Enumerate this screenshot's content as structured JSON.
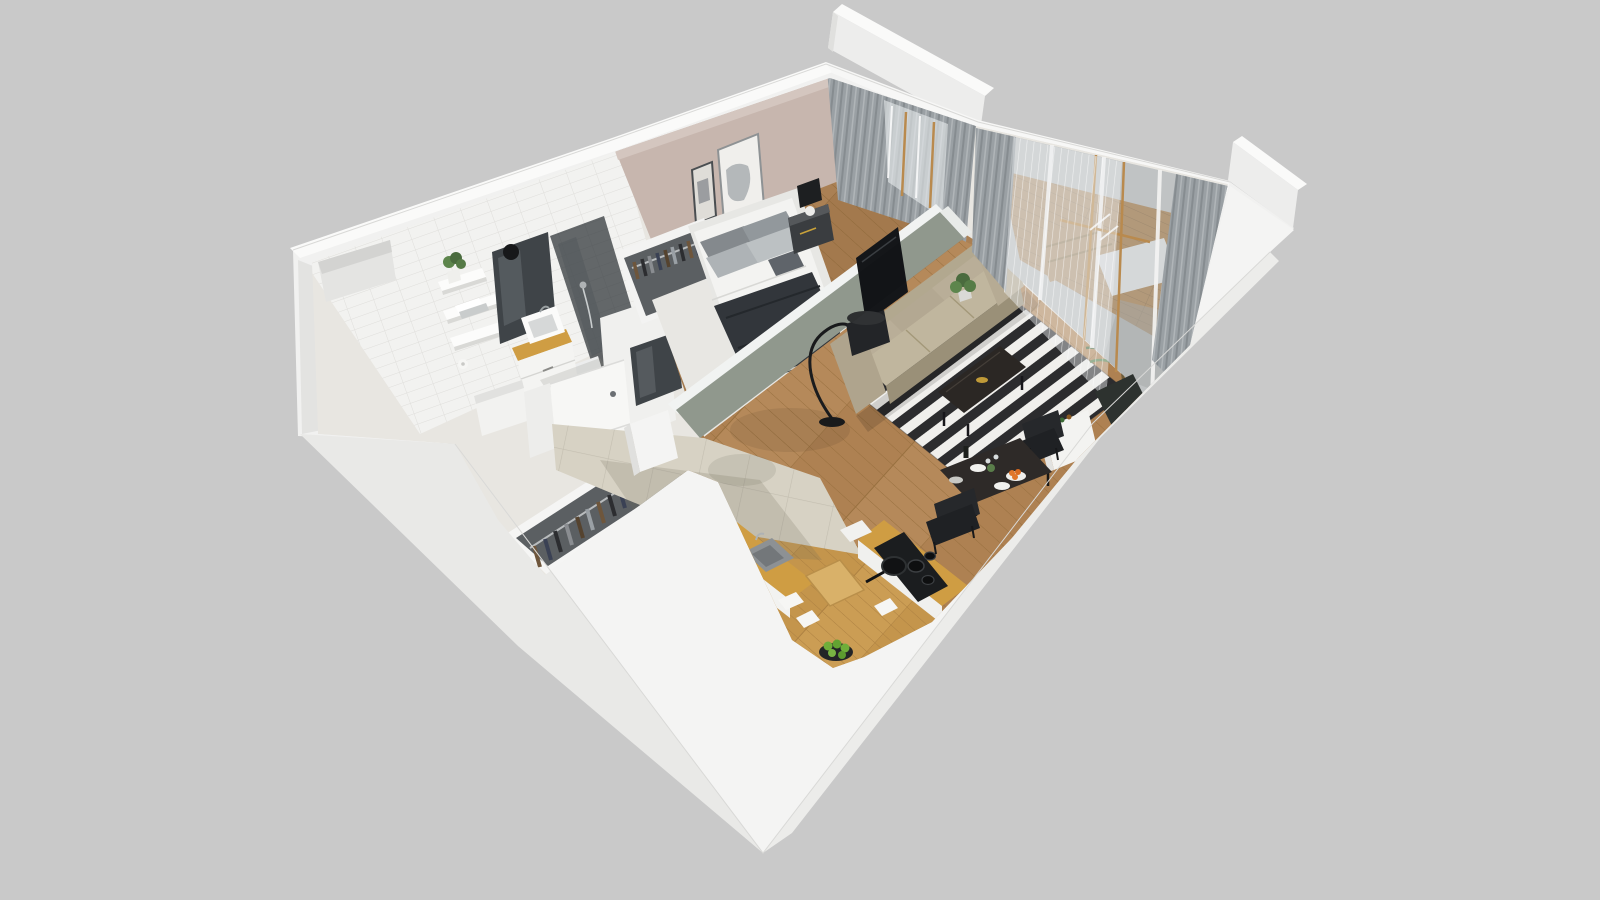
{
  "scene": {
    "type": "3d-floor-plan-render",
    "view": "isometric-cutaway-apartment",
    "background_color": "#c9c9c9",
    "colors": {
      "bg": "#c9c9c9",
      "wallBright": "#fafaf9",
      "wallFace": "#f1f1f0",
      "wallShade": "#e9e9e7",
      "wallDark": "#e3e3e1",
      "plinthTop": "#f4f4f3",
      "tileWallBase": "#f2f2f0",
      "tileGrout": "#dfdedb",
      "mauveWall": "#c7b6ae",
      "mauveWallLight": "#d4c6bf",
      "sageWall": "#99a296",
      "woodFloor": "#b5895a",
      "plankLine": "#98703f",
      "oakFloor": "#cb9d54",
      "kitchenTile": "#d7d2c4",
      "kitchenTileLine": "#c3beb0",
      "counterWood": "#cf9d43",
      "rugDark": "#2c2c2e",
      "rugLight": "#f0efec",
      "sofaBase": "#b2a88f",
      "sofaLight": "#c0b69e",
      "sofaDark": "#9a9078",
      "mattressWhite": "#f3f3f1",
      "pillowGray": "#8d9296",
      "throwDark": "#32363b",
      "curtainGray": "#9aa0a4",
      "sheerWhite": "#edf0f1",
      "glassTint": "#b6bdc0",
      "woodFrame": "#b98a4e",
      "tvBlack": "#141619",
      "blackFurniture": "#232528",
      "deckWood": "#b08048",
      "plantGreen": "#4a6b3e",
      "plantGreenLight": "#5d854c",
      "appleGreen": "#6fae3a",
      "orangeFruit": "#e0762a",
      "brass": "#c09a38",
      "doorWhite": "#f7f7f5",
      "mirrorDark": "#3f4448",
      "wardrobeInner": "#5b5f62"
    },
    "rooms": [
      {
        "id": "bathroom",
        "objects": [
          "tiled-wall",
          "wall-shelves",
          "towels",
          "potted-plant",
          "mirror-panel",
          "wall-sconce",
          "shower-glass",
          "shower-hose",
          "vanity-sink",
          "toilet-paper-holder",
          "bench-box"
        ]
      },
      {
        "id": "hallway",
        "objects": [
          "entry-door",
          "wall-mirror",
          "wardrobe-clothes-rail"
        ]
      },
      {
        "id": "bedroom",
        "objects": [
          "double-bed",
          "pillows",
          "dark-throw",
          "area-rug",
          "nightstand",
          "table-lamp",
          "wall-art-large",
          "wall-art-small",
          "gray-curtains",
          "open-clothes-rack"
        ]
      },
      {
        "id": "living-room",
        "objects": [
          "sofa",
          "arc-floor-lamp",
          "striped-rug",
          "coffee-table",
          "wall-tv",
          "plant-behind-sofa",
          "palm-plant"
        ]
      },
      {
        "id": "kitchen",
        "objects": [
          "sink-counter",
          "kitchen-sink",
          "coffee-machine",
          "cooktop-counter",
          "cooktop",
          "frying-pan",
          "cutting-board",
          "fruit-bowl-apples",
          "tall-cabinet"
        ]
      },
      {
        "id": "dining-area",
        "objects": [
          "dining-table",
          "plates",
          "orange-bowl",
          "wine-bottle",
          "dining-chair-upper",
          "dining-chair-lower",
          "sideboard"
        ]
      },
      {
        "id": "balcony",
        "objects": [
          "glass-sliding-doors",
          "sheer-curtains",
          "gray-curtains",
          "wood-deck",
          "lounger",
          "lounger-cushion",
          "planter-box",
          "parapet-wall-top",
          "parapet-wall-right"
        ]
      }
    ]
  }
}
